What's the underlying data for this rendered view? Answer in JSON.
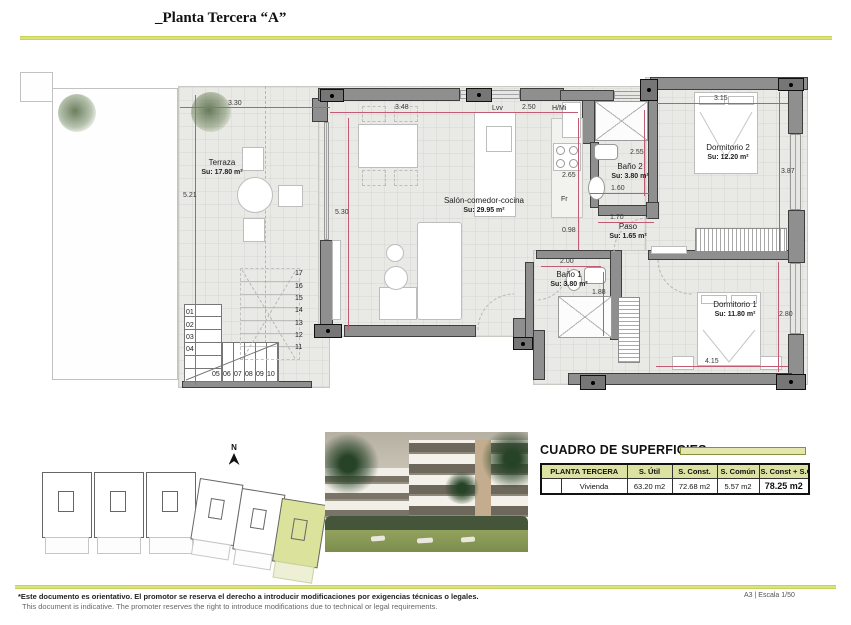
{
  "page": {
    "title": "_Planta Tercera “A”",
    "sheet_info": "A3 | Escala 1/50",
    "disclaimer_es": "*Este documento es orientativo. El promotor se reserva el derecho a introducir modificaciones por exigencias técnicas o legales.",
    "disclaimer_en": "This document is indicative. The promoter reserves the right to introduce modifications due to technical or legal requirements."
  },
  "colors": {
    "accent": "#c8d34b",
    "table_header_bg": "#dce3a2",
    "wall_gray": "#8f8f8f",
    "dimension_magenta": "#c25a74",
    "site_highlight": "#dbe29b"
  },
  "plan": {
    "rooms": {
      "terraza": {
        "name": "Terraza",
        "area": "Su: 17.80 m²"
      },
      "salon": {
        "name": "Salón-comedor-cocina",
        "area": "Su: 29.95 m²"
      },
      "bano2": {
        "name": "Baño 2",
        "area": "Su: 3.80 m²"
      },
      "dormitorio2": {
        "name": "Dormitorio 2",
        "area": "Su: 12.20 m²"
      },
      "paso": {
        "name": "Paso",
        "area": "Su: 1.65 m²"
      },
      "bano1": {
        "name": "Baño 1",
        "area": "Su: 3.80 m²"
      },
      "dormitorio1": {
        "name": "Dormitorio 1",
        "area": "Su: 11.80 m²"
      }
    },
    "labels": {
      "kitchen_island": "Lvv",
      "laundry": "H/Mi",
      "fridge": "Fr",
      "north": "N"
    },
    "dims": {
      "terraza_w": "3.30",
      "terraza_h": "5.21",
      "salon_w": "3.48",
      "kitchen_w": "2.50",
      "salon_h": "5.30",
      "kitchen_h": "2.65",
      "hall_w": "0.98",
      "bano2_h": "2.55",
      "bano2_w": "1.60",
      "paso_w": "1.70",
      "dorm2_w": "3.15",
      "dorm2_h": "3.87",
      "bano1_w": "2.00",
      "bano1_h": "1.88",
      "dorm1_h": "2.80",
      "dorm1_w": "4.15"
    },
    "stairs": {
      "upper": [
        "17",
        "16",
        "15",
        "14",
        "13",
        "12",
        "11"
      ],
      "left": [
        "01",
        "02",
        "03",
        "04"
      ],
      "bottom": [
        "05",
        "06",
        "07",
        "08",
        "09",
        "10"
      ]
    }
  },
  "surfaces_table": {
    "title": "CUADRO DE SUPERFICIES",
    "columns": [
      "PLANTA TERCERA",
      "S. Útil",
      "S. Const.",
      "S. Común",
      "S. Const + S.C"
    ],
    "row": {
      "label": "Vivienda",
      "s_util": "63.20 m2",
      "s_const": "72.68 m2",
      "s_comun": "5.57 m2",
      "s_total": "78.25 m2"
    }
  }
}
